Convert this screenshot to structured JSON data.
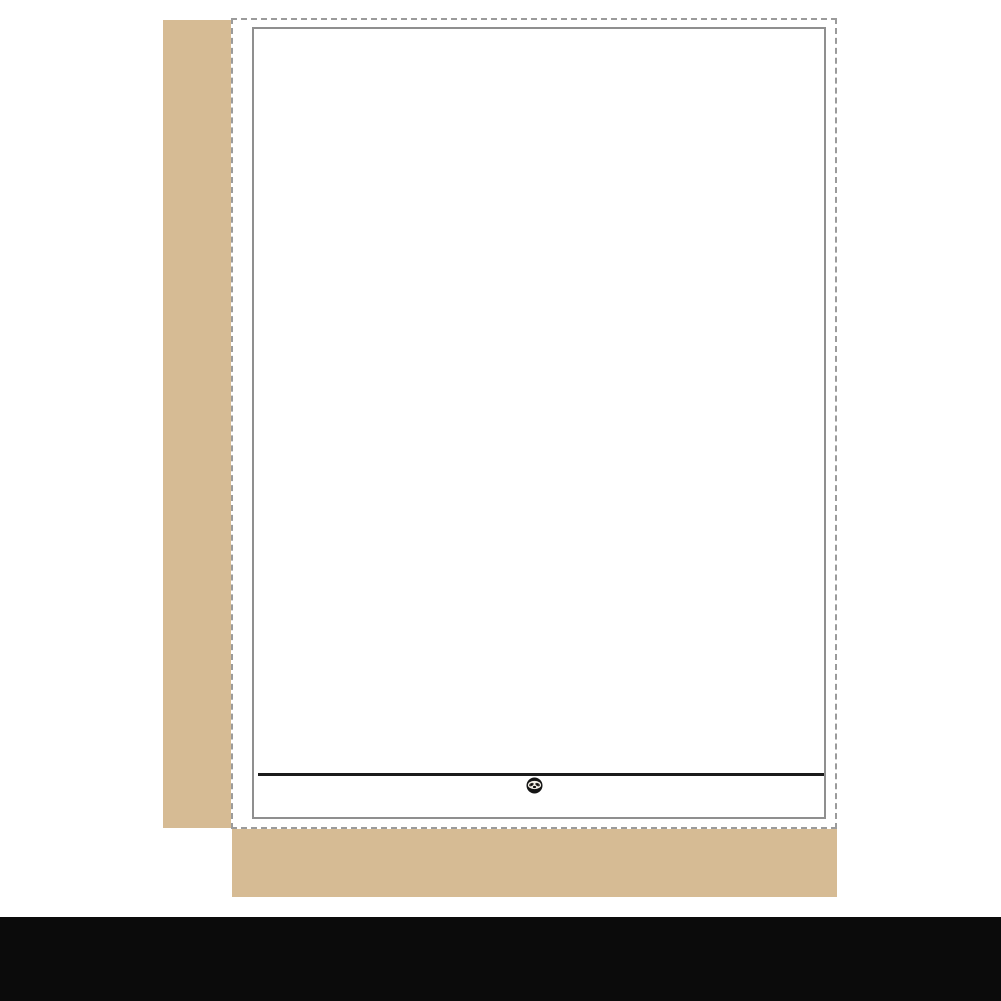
{
  "product": {
    "sticker": {
      "line1": "THE",
      "line2": "END."
    },
    "grid": {
      "rows": 12,
      "cols": 9
    },
    "sheet_footer": {
      "website": "SNIGGLESLOTH.COM",
      "logo_top": "SNIGGLE",
      "logo_bottom_left": "SL",
      "logo_bottom_right": "TH",
      "logo_trademark": "™",
      "languages": "Stickers  |  Autocollants"
    }
  },
  "rulers": {
    "unit": "INCH",
    "left_marks": [
      "1",
      "2",
      "3",
      "4",
      "5",
      "6",
      "7",
      "8"
    ],
    "bottom_marks": [
      "1",
      "2",
      "3",
      "4",
      "5",
      "6"
    ]
  },
  "banner": {
    "text": "SNIGGLE SLOTH™ - SLOW DOWN & CRAFT"
  },
  "colors": {
    "kraft": "#d6bb94",
    "ink": "#1d1d1b",
    "cut_line": "#9b9b9b",
    "sheet_border": "#8f8f8f",
    "circle_border": "#d8d8d8",
    "banner_bg": "#0b0b0b",
    "banner_text": "#ffffff"
  }
}
